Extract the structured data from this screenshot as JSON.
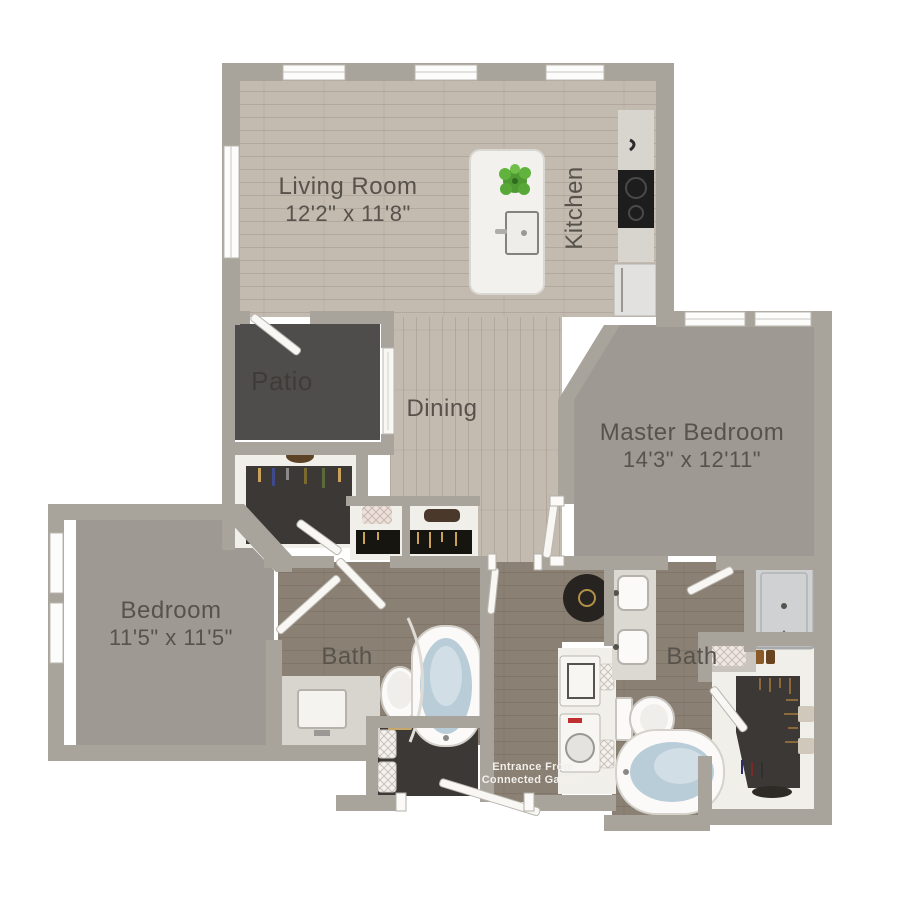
{
  "floorplan": {
    "rooms": {
      "living": {
        "name": "Living Room",
        "dims": "12'2\" x 11'8\""
      },
      "kitchen": {
        "name": "Kitchen"
      },
      "patio": {
        "name": "Patio"
      },
      "dining": {
        "name": "Dining"
      },
      "master": {
        "name": "Master Bedroom",
        "dims": "14'3\" x 12'11\""
      },
      "bedroom": {
        "name": "Bedroom",
        "dims": "11'5\" x 11'5\""
      },
      "bath1": {
        "name": "Bath"
      },
      "bath2": {
        "name": "Bath"
      }
    },
    "entrance": {
      "line1": "Entrance From",
      "line2": "Connected Garage"
    },
    "colors": {
      "wall": "#a9a49b",
      "wood_light": "#c3bab0",
      "wood_dark": "#8a8073",
      "carpet": "#9e9a93",
      "patio_floor": "#4e4d4b",
      "closet_floor": "#3c3835",
      "fixture_white": "#f7f6f3",
      "tub_water": "#b9cdd9",
      "label_text": "#57534c",
      "entrance_text": "#f2f0ec",
      "plant_green": "#5cab3a"
    }
  }
}
